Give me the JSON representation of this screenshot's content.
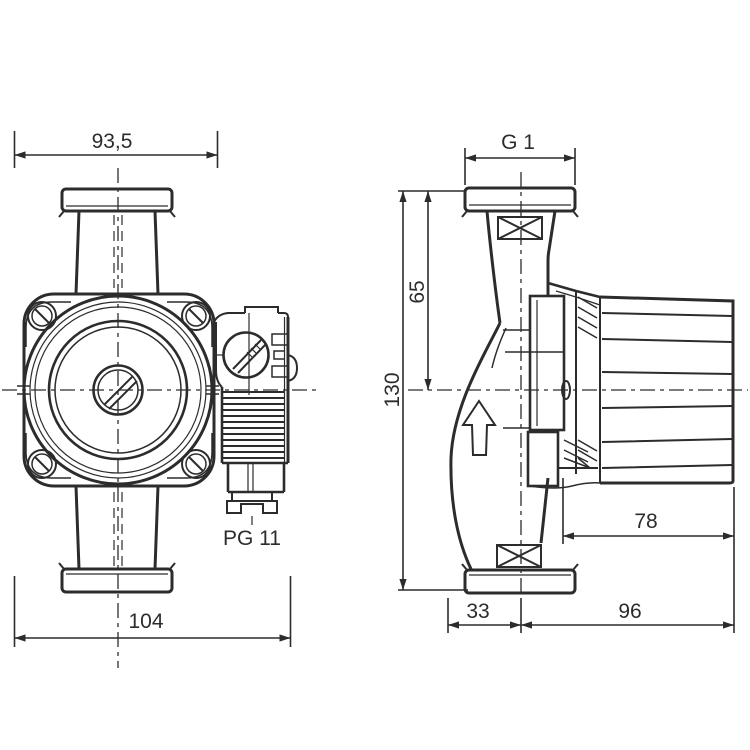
{
  "drawing": {
    "line_color": "#2c2c2c",
    "background_color": "#ffffff",
    "front_view": {
      "top_width": "93,5",
      "overall_width": "104",
      "cable_gland": "PG 11"
    },
    "side_view": {
      "port_thread": "G 1",
      "port_to_axis": "65",
      "overall_height": "130",
      "motor_depth": "78",
      "axis_to_front": "33",
      "axis_to_back": "96"
    }
  }
}
